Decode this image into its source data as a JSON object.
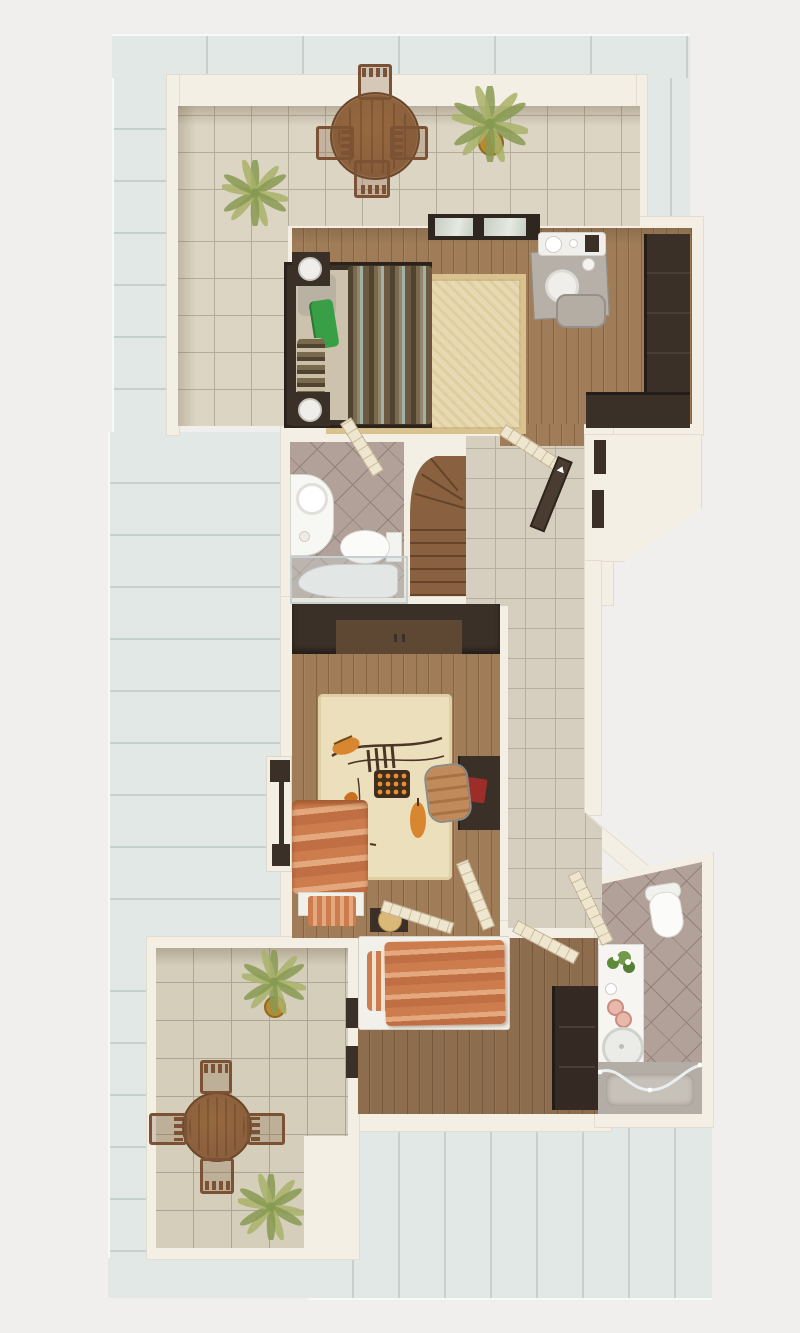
{
  "scene": {
    "type": "3d-floor-plan-render",
    "view": "top-down isometric dollhouse",
    "visible_text": "none",
    "rooms": [
      "roof-deck",
      "upper-terrace",
      "studio-bedroom",
      "mid-bathroom",
      "winder-staircase",
      "entry-hallway",
      "living-room",
      "lower-bathroom",
      "lower-bedroom",
      "lower-terrace"
    ],
    "furniture": [
      "round-patio-table",
      "patio-chair",
      "potted-palm",
      "double-bed",
      "nightstand-lamp",
      "area-rug",
      "desk",
      "desk-chair",
      "corner-sofa",
      "glass-window",
      "vanity-sink",
      "toilet",
      "shower-tub",
      "entry-door",
      "wardrobe",
      "chaise-lounge",
      "office-chair",
      "laptop",
      "stool",
      "single-bed",
      "corner-bathtub",
      "flower-vase"
    ]
  },
  "colors": {
    "bg": "#f0efed",
    "roof": "#e2e8e5",
    "roof-line": "#c6d0cd",
    "roof-edge": "#f7f9f8",
    "wall-light": "#f4efe4",
    "wall-mid": "#e8e0cd",
    "door": "#efe6d0",
    "door-line": "#cdbd9c",
    "tile-a": "#dcd5c3",
    "tile-grout": "#b5ad99",
    "tile-b": "#d5cebb",
    "tile-b-grout": "#aea694",
    "hall-tile": "#d6cfc0",
    "hall-grout": "#b6aea0",
    "bath-tile": "#b2a199",
    "bath-line": "#93807a",
    "wood-a": "#a07c58",
    "dark-furn": "#3a3028",
    "dark-furn-2": "#4a3c30",
    "wardrobe-panel": "#5e4733",
    "gray-top": "#b6b0a8",
    "white-furn": "#f2f0ea",
    "mattress": "#ccc2ae",
    "pillow-green": "#389f47",
    "stripe-olive": "#7a6a4d",
    "stripe-teal": "#9fb3a5",
    "stripe-dark": "#50432f",
    "rug": "#e7d9b1",
    "rug-border": "#d9c28e",
    "orange": "#cd7c4e",
    "orange-light": "#e3a87d",
    "orange-deep": "#c06f44",
    "red-item": "#9c2d28",
    "chair-tan": "#c08a5a",
    "stairs-a": "#8a6140",
    "glass": "#c6cdc1",
    "glass-frame": "#2f2620",
    "table-wood": "#8a5f3c",
    "chair-wood": "#7b5334",
    "palm-1": "#a9b168",
    "palm-2": "#879a52",
    "pot": "#b9892f",
    "tub": "#b3ada5",
    "tub-inner": "#c6c1b9",
    "porcelain": "#f7f7f4",
    "porcelain-line": "#d4d4cf",
    "chrome": "#e9eef0"
  }
}
